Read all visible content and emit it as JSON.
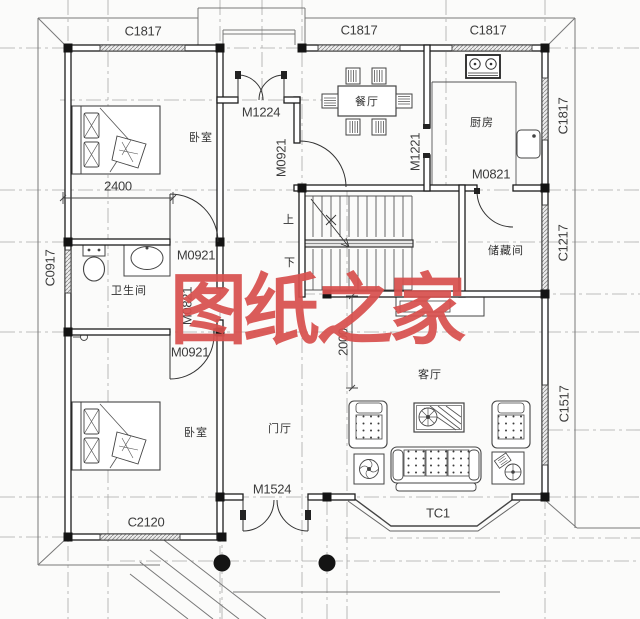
{
  "watermark": {
    "text": "图纸之家",
    "color": "#d8504e"
  },
  "rooms": {
    "bedroom1": "卧室",
    "bedroom2": "卧室",
    "dining": "餐厅",
    "kitchen": "厨房",
    "bath": "卫生间",
    "storage": "储藏间",
    "living": "客厅",
    "foyer": "门厅"
  },
  "stairs": {
    "up": "上",
    "down": "下"
  },
  "dims": {
    "w2400": "2400",
    "h2000": "2000"
  },
  "windows": {
    "top1": "C1817",
    "top2": "C1817",
    "top3": "C1817",
    "right_top": "C1817",
    "right_mid": "C1217",
    "right_low": "C1517",
    "left": "C0917",
    "bottom": "C2120",
    "bay": "TC1"
  },
  "doors": {
    "m1224": "M1224",
    "m0921_hall": "M0921",
    "m1221": "M1221",
    "m0821_kitchen": "M0821",
    "m0921_bath": "M0921",
    "m0821_mid": "M0821",
    "m0921_lower": "M0921",
    "m1524": "M1524"
  }
}
